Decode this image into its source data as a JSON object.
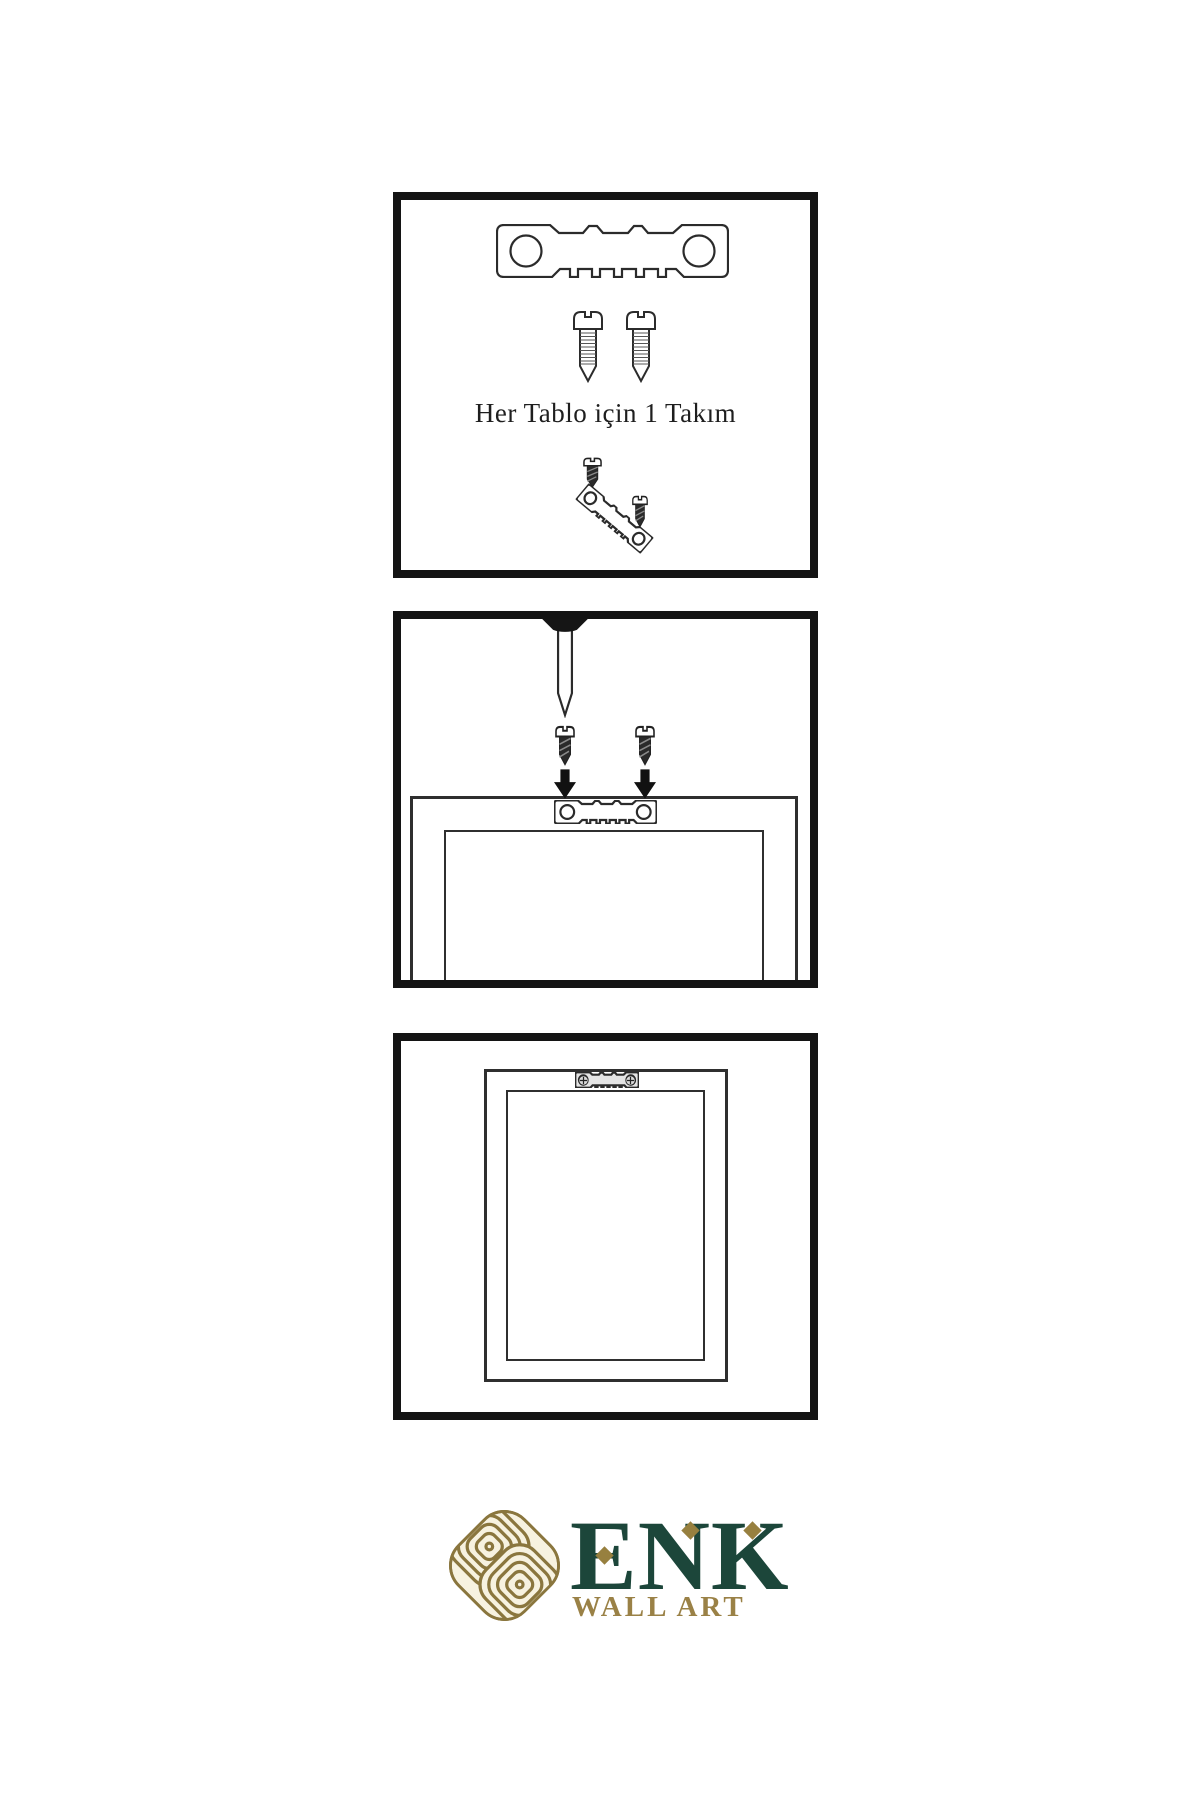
{
  "step1": {
    "caption": "Her Tablo için 1 Takım"
  },
  "brand": {
    "name": "ENK",
    "tagline": "WALL ART"
  },
  "colors": {
    "panel_border": "#141414",
    "line_art": "#2b2b2b",
    "dark_metal": "#2a2a2a",
    "logo_green": "#1c463a",
    "logo_gold": "#97803f",
    "knot_stroke": "#8a763e",
    "knot_cream": "#f7f2e0"
  },
  "icons": {
    "sawtooth-hanger-icon": "metal sawtooth picture hanger plate with two screw holes",
    "screw-outline-icon": "threaded wood screw, outline style",
    "screw-dark-icon": "small dark wood screw",
    "nail-icon": "wall nail hammered through top edge",
    "arrow-down-icon": "solid black downward arrow",
    "frame-back-icon": "back of picture frame",
    "phillips-head-icon": "phillips screw head, mounted",
    "knot-icon": "interlocked celtic knot brand mark"
  }
}
